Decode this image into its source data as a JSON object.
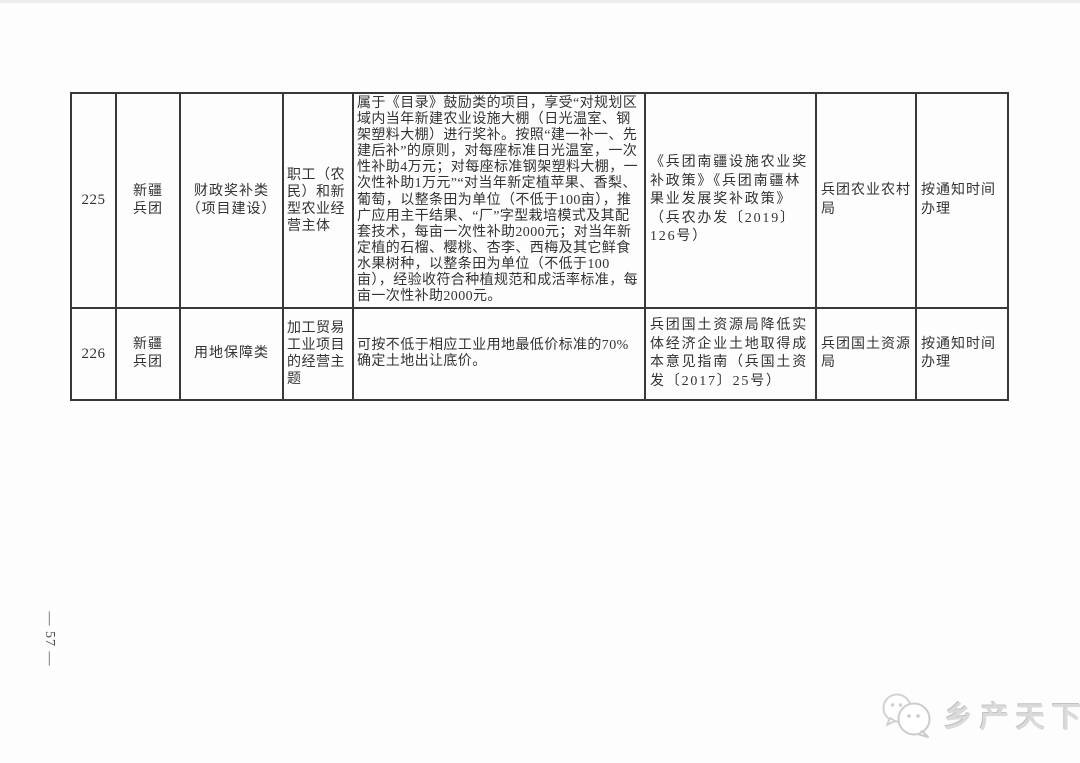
{
  "page": {
    "number_label": "— 57 —"
  },
  "table": {
    "rows": [
      {
        "id": "225",
        "region": "新疆\n兵团",
        "category": "财政奖补类\n（项目建设）",
        "target": "职工（农民）和新型农业经营主体",
        "measure": "属于《目录》鼓励类的项目，享受“对规划区域内当年新建农业设施大棚（日光温室、钢架塑料大棚）进行奖补。按照“建一补一、先建后补”的原则，对每座标准日光温室，一次性补助4万元；对每座标准钢架塑料大棚，一次性补助1万元”“对当年新定植苹果、香梨、葡萄，以整条田为单位（不低于100亩），推广应用主干结果、“厂”字型栽培模式及其配套技术，每亩一次性补助2000元；对当年新定植的石榴、樱桃、杏李、西梅及其它鲜食水果树种，以整条田为单位（不低于100亩），经验收符合种植规范和成活率标准，每亩一次性补助2000元。",
        "basis": "《兵团南疆设施农业奖补政策》《兵团南疆林果业发展奖补政策》（兵农办发〔2019〕126号）",
        "department": "兵团农业农村局",
        "timing": "按通知时间办理"
      },
      {
        "id": "226",
        "region": "新疆\n兵团",
        "category": "用地保障类",
        "target": "加工贸易工业项目的经营主题",
        "measure": "可按不低于相应工业用地最低价标准的70%确定土地出让底价。",
        "basis": "兵团国土资源局降低实体经济企业土地取得成本意见指南（兵国土资发〔2017〕25号）",
        "department": "兵团国土资源局",
        "timing": "按通知时间办理"
      }
    ]
  },
  "watermark": {
    "brand": "乡产天下",
    "logo": "chat-bubbles-logo"
  },
  "colors": {
    "border": "#383838",
    "text": "#333333",
    "watermark": "#dadada"
  }
}
